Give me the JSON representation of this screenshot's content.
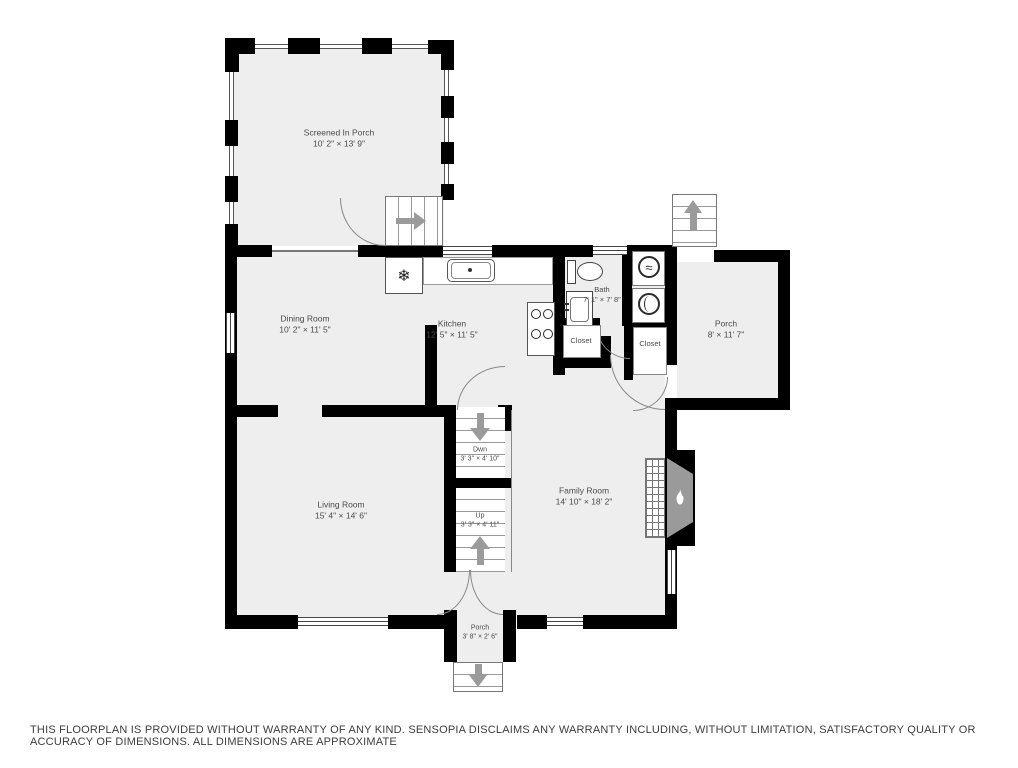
{
  "disclaimer": "THIS FLOORPLAN IS PROVIDED WITHOUT WARRANTY OF ANY KIND. SENSOPIA DISCLAIMS ANY WARRANTY INCLUDING, WITHOUT LIMITATION, SATISFACTORY QUALITY OR ACCURACY OF DIMENSIONS. ALL DIMENSIONS ARE APPROXIMATE",
  "colors": {
    "wall": "#000000",
    "room_fill": "#eeeeee",
    "line": "#555555",
    "arrow": "#9b9b9b",
    "label": "#4a4a4a",
    "background": "#ffffff"
  },
  "rooms": {
    "screened_porch": {
      "name": "Screened In Porch",
      "dims": "10' 2\" × 13' 9\""
    },
    "dining_room": {
      "name": "Dining Room",
      "dims": "10' 2\" × 11' 5\""
    },
    "kitchen": {
      "name": "Kitchen",
      "dims": "12' 5\" × 11' 5\""
    },
    "bath": {
      "name": "Bath",
      "dims": "7' 1\" × 7' 8\""
    },
    "closet_left": {
      "name": "Closet"
    },
    "closet_right": {
      "name": "Closet"
    },
    "side_porch": {
      "name": "Porch",
      "dims": "8' × 11' 7\""
    },
    "family_room": {
      "name": "Family Room",
      "dims": "14' 10\" × 18' 2\""
    },
    "living_room": {
      "name": "Living Room",
      "dims": "15' 4\" × 14' 6\""
    },
    "stairs_down": {
      "name": "Dwn",
      "dims": "3' 3\" × 4' 10\""
    },
    "stairs_up": {
      "name": "Up",
      "dims": "3' 3\" × 4' 11\""
    },
    "front_porch": {
      "name": "Porch",
      "dims": "3' 8\" × 2' 6\""
    }
  },
  "icons": {
    "fridge_glyph": "❄",
    "washer_glyph": "≈"
  }
}
